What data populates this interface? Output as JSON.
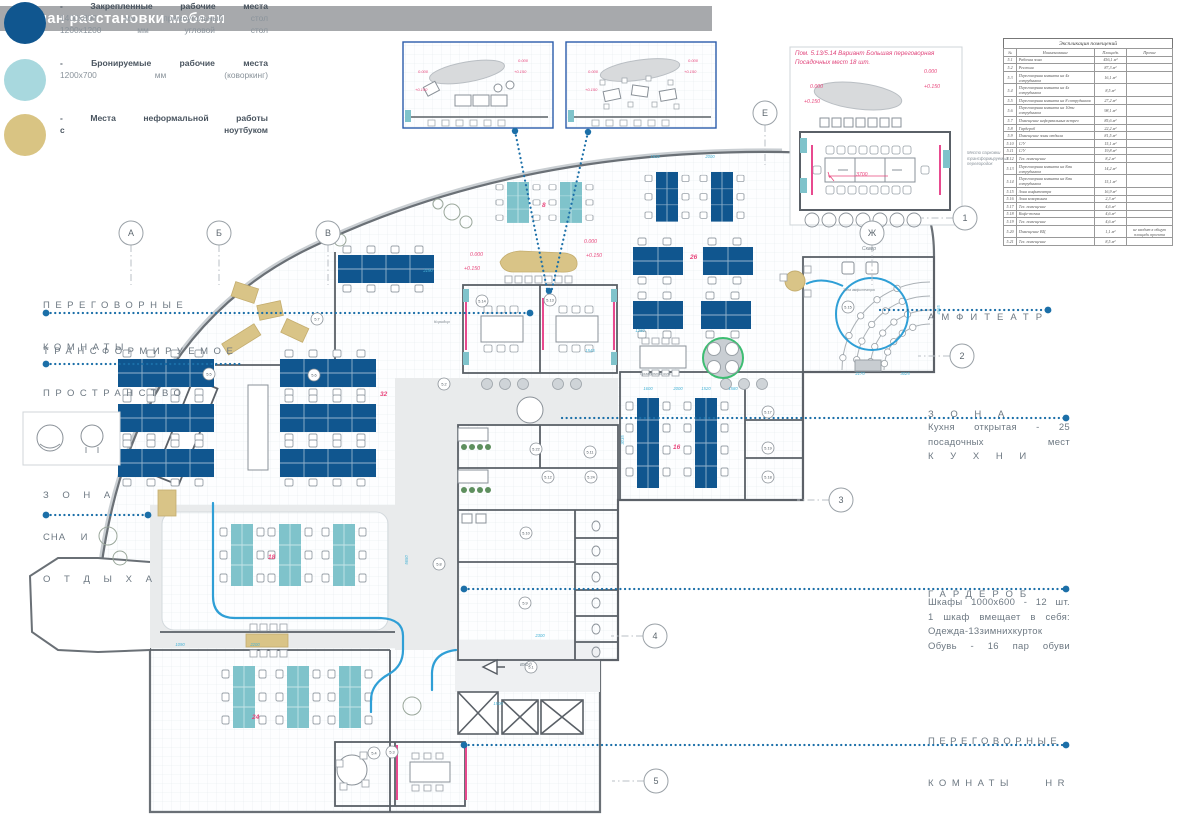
{
  "header": {
    "title": "План расстановки мебели"
  },
  "legend": {
    "items": [
      {
        "color": "#10568f",
        "line1": "- Закрепленные рабочие места",
        "line2": "1400х800 мм прямоугольный стол",
        "line3": "1200х1200 мм угловой стол"
      },
      {
        "color": "#a8d8de",
        "line1": "- Бронируемые рабочие места",
        "line2": "1200х700 мм (коворкинг)",
        "line3": ""
      },
      {
        "color": "#d9c483",
        "line1": "- Места неформальной работы",
        "line2": "с ноутбуком",
        "line3": ""
      }
    ]
  },
  "zones": {
    "left": [
      {
        "lines": [
          "ПЕРЕГОВОРНЫЕ",
          "КОМНАТЫ"
        ]
      },
      {
        "lines": [
          "ТРАНСФОРМИРУЕМОЕ",
          "ПРОСТРАНСТВО"
        ]
      },
      {
        "lines": [
          "З О Н А",
          "СНА    И",
          "О Т Д Ы Х А"
        ]
      }
    ],
    "right": [
      {
        "lines": [
          "АМФИТЕАТР"
        ],
        "body": []
      },
      {
        "lines": [
          "З О Н А",
          "К У Х Н И"
        ],
        "body": [
          "Кухня открытая - 25",
          "посадочных мест"
        ]
      },
      {
        "lines": [
          "ГАРДЕРОБ"
        ],
        "body": [
          "Шкафы 1000х600 - 12 шт.",
          "1 шкаф вмещает в себя:",
          "Одежда-13зимнихкурток",
          "Обувь - 16 пар обуви"
        ]
      },
      {
        "lines": [
          "ПЕРЕГОВОРНЫЕ"
        ],
        "line2_left": "КОМНАТЫ",
        "line2_right": "HR",
        "body": []
      }
    ]
  },
  "annotation": {
    "lines": [
      "Пом. 5.13/5.14 Вариант Большая переговорная",
      "Посадочных мест 18 шт."
    ]
  },
  "detail_note": {
    "lines": [
      "Место парковки",
      "трансформируемых",
      "перегородок"
    ]
  },
  "table": {
    "title": "Экспликация помещений",
    "headers": [
      "№",
      "Наименование",
      "Площадь",
      "Прочие"
    ],
    "rows": [
      [
        "5.1",
        "Рабочая зона",
        "456,1 м²",
        ""
      ],
      [
        "5.2",
        "Ресепшн",
        "87,3 м²",
        ""
      ],
      [
        "5.3",
        "Переговорная комната на 4х сотрудников",
        "16,1 м²",
        ""
      ],
      [
        "5.4",
        "Переговорная комната на 4х сотрудников",
        "8,5 м²",
        ""
      ],
      [
        "5.5",
        "Переговорная комната на 8 сотрудников",
        "27,2 м²",
        ""
      ],
      [
        "5.6",
        "Переговорная комната на 10ти сотрудников",
        "98,1 м²",
        ""
      ],
      [
        "5.7",
        "Помещение неформальных встреч",
        "85,6 м²",
        ""
      ],
      [
        "5.8",
        "Гардероб",
        "22,2 м²",
        ""
      ],
      [
        "5.9",
        "Помещение зоны отдыха",
        "81,5 м²",
        ""
      ],
      [
        "5.10",
        "С/У",
        "15,1 м²",
        ""
      ],
      [
        "5.11",
        "С/У",
        "19,8 м²",
        ""
      ],
      [
        "5.12",
        "Тех. помещение",
        "8,2 м²",
        ""
      ],
      [
        "5.13",
        "Переговорная комната на 8ми сотрудников",
        "14,2 м²",
        ""
      ],
      [
        "5.14",
        "Переговорная комната на 8ми сотрудников",
        "15,1 м²",
        ""
      ],
      [
        "5.15",
        "Зона амфитеатра",
        "16,9 м²",
        ""
      ],
      [
        "5.16",
        "Зона коворкинга",
        "2,3 м²",
        ""
      ],
      [
        "5.17",
        "Тех. помещение",
        "4,6 м²",
        ""
      ],
      [
        "5.18",
        "Кофе-точка",
        "4,6 м²",
        ""
      ],
      [
        "5.19",
        "Тех. помещение",
        "4,6 м²",
        ""
      ],
      [
        "5.20",
        "Помещение ВЦ",
        "1,1 м²",
        "не входит в общую площадь проекта"
      ],
      [
        "5.21",
        "Тех. помещение",
        "8,5 м²",
        ""
      ]
    ]
  },
  "plan": {
    "grid_letters": [
      {
        "t": "А",
        "x": 131,
        "y": 233
      },
      {
        "t": "Б",
        "x": 219,
        "y": 233
      },
      {
        "t": "В",
        "x": 328,
        "y": 233
      },
      {
        "t": "Е",
        "x": 765,
        "y": 113
      },
      {
        "t": "Ж",
        "x": 872,
        "y": 233
      }
    ],
    "grid_numbers": [
      {
        "t": "1",
        "x": 965,
        "y": 218
      },
      {
        "t": "2",
        "x": 962,
        "y": 356
      },
      {
        "t": "3",
        "x": 841,
        "y": 500
      },
      {
        "t": "4",
        "x": 655,
        "y": 636
      },
      {
        "t": "5",
        "x": 656,
        "y": 781
      }
    ],
    "rooms": [
      {
        "t": "5.14",
        "x": 482,
        "y": 301
      },
      {
        "t": "5.13",
        "x": 550,
        "y": 300
      },
      {
        "t": "5.7",
        "x": 317,
        "y": 319
      },
      {
        "t": "5.5",
        "x": 209,
        "y": 374
      },
      {
        "t": "5.6",
        "x": 314,
        "y": 375
      },
      {
        "t": "5.2",
        "x": 444,
        "y": 384
      },
      {
        "t": "5.15",
        "x": 848,
        "y": 307
      },
      {
        "t": "5.17",
        "x": 768,
        "y": 412
      },
      {
        "t": "5.19",
        "x": 768,
        "y": 448
      },
      {
        "t": "5.18",
        "x": 768,
        "y": 477
      },
      {
        "t": "5.22",
        "x": 536,
        "y": 449
      },
      {
        "t": "5.11",
        "x": 590,
        "y": 452
      },
      {
        "t": "5.12",
        "x": 548,
        "y": 477
      },
      {
        "t": "5.24",
        "x": 591,
        "y": 477
      },
      {
        "t": "5.10",
        "x": 526,
        "y": 533
      },
      {
        "t": "5.9",
        "x": 525,
        "y": 603
      },
      {
        "t": "5.8",
        "x": 439,
        "y": 564
      },
      {
        "t": "5.1",
        "x": 531,
        "y": 667
      },
      {
        "t": "5.4",
        "x": 374,
        "y": 753
      },
      {
        "t": "5.3",
        "x": 392,
        "y": 752
      }
    ],
    "red_marks": [
      {
        "t": "0.000",
        "x": 470,
        "y": 256
      },
      {
        "t": "+0.150",
        "x": 464,
        "y": 270
      },
      {
        "t": "0.000",
        "x": 584,
        "y": 243
      },
      {
        "t": "+0.150",
        "x": 586,
        "y": 257
      },
      {
        "t": "0.000",
        "x": 924,
        "y": 73
      },
      {
        "t": "+0.150",
        "x": 924,
        "y": 88
      },
      {
        "t": "0.000",
        "x": 810,
        "y": 88
      },
      {
        "t": "+0.150",
        "x": 804,
        "y": 103
      },
      {
        "t": "3700",
        "x": 856,
        "y": 176
      },
      {
        "t": "0.000",
        "x": 518,
        "y": 62,
        "s": 4
      },
      {
        "t": "+0.150",
        "x": 514,
        "y": 73,
        "s": 4
      },
      {
        "t": "0.000",
        "x": 418,
        "y": 73,
        "s": 4
      },
      {
        "t": "+0.150",
        "x": 415,
        "y": 91,
        "s": 4
      },
      {
        "t": "0.000",
        "x": 688,
        "y": 62,
        "s": 4
      },
      {
        "t": "+0.150",
        "x": 684,
        "y": 73,
        "s": 4
      },
      {
        "t": "0.000",
        "x": 588,
        "y": 73,
        "s": 4
      },
      {
        "t": "+0.150",
        "x": 585,
        "y": 91,
        "s": 4
      }
    ],
    "counts": [
      {
        "t": "8",
        "x": 542,
        "y": 207
      },
      {
        "t": "26",
        "x": 690,
        "y": 259
      },
      {
        "t": "32",
        "x": 380,
        "y": 396
      },
      {
        "t": "18",
        "x": 268,
        "y": 559
      },
      {
        "t": "16",
        "x": 673,
        "y": 449
      },
      {
        "t": "24",
        "x": 252,
        "y": 719
      }
    ],
    "dims": [
      {
        "t": "2190",
        "x": 428,
        "y": 272
      },
      {
        "t": "1925",
        "x": 655,
        "y": 158
      },
      {
        "t": "2000",
        "x": 710,
        "y": 158
      },
      {
        "t": "2170",
        "x": 860,
        "y": 375
      },
      {
        "t": "3025",
        "x": 905,
        "y": 375
      },
      {
        "t": "1600",
        "x": 648,
        "y": 390
      },
      {
        "t": "2000",
        "x": 678,
        "y": 390
      },
      {
        "t": "1520",
        "x": 706,
        "y": 390
      },
      {
        "t": "1580",
        "x": 733,
        "y": 390
      },
      {
        "t": "2300",
        "x": 540,
        "y": 637
      },
      {
        "t": "1500",
        "x": 498,
        "y": 705
      },
      {
        "t": "2200",
        "x": 255,
        "y": 646
      },
      {
        "t": "1090",
        "x": 180,
        "y": 646
      },
      {
        "t": "1280",
        "x": 640,
        "y": 332
      },
      {
        "t": "1545",
        "x": 590,
        "y": 352
      },
      {
        "t": "5650",
        "x": 408,
        "y": 560,
        "r": -90
      },
      {
        "t": "3035",
        "x": 624,
        "y": 440,
        "r": -90
      },
      {
        "t": "4965",
        "x": 940,
        "y": 310,
        "r": -90
      }
    ],
    "misc_labels": [
      {
        "text": "Сквер",
        "x": 862,
        "y": 246,
        "s": 5
      },
      {
        "text": "вход",
        "x": 520,
        "y": 662,
        "s": 5.5
      },
      {
        "text": "Коридор",
        "x": 434,
        "y": 319,
        "s": 4
      },
      {
        "text": "Зона амфитеатра",
        "x": 843,
        "y": 288,
        "s": 3.5
      },
      {
        "text": "Примерочная зона",
        "x": 640,
        "y": 372,
        "s": 3.5
      }
    ]
  },
  "colors": {
    "header_gray": "#a7a9ac",
    "fixed_workplace_blue": "#10568f",
    "bookable_teal": "#a8d8de",
    "desk_teal": "#7fc3cb",
    "informal_tan": "#d9c483",
    "leader_blue": "#1b6fa8",
    "route_blue": "#2f9fd6",
    "dimension_cyan": "#49b4d6",
    "red_pink": "#e8467c",
    "wall_gray": "#5a6067",
    "label_gray": "#6e7983",
    "glass_pink": "#e84a8f"
  }
}
